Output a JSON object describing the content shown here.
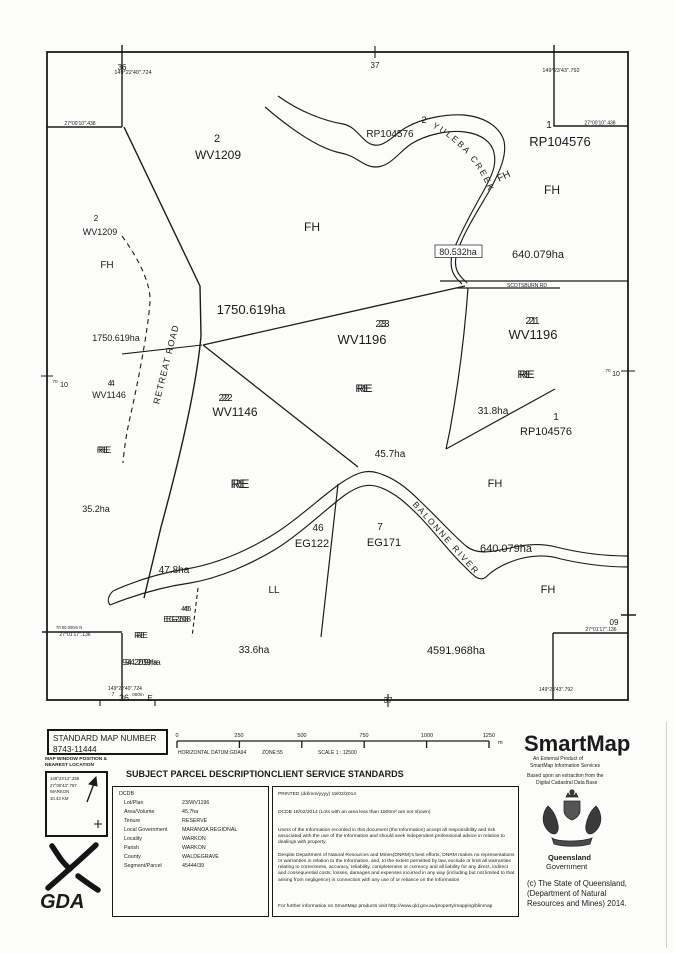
{
  "map": {
    "grid": {
      "top_36": "36",
      "top_37": "37",
      "bottom_37": "37",
      "right_09": "09",
      "left_70": "70",
      "left_10": "10",
      "right_70": "70",
      "right_10": "10",
      "northing_label": "70 00 000m N",
      "easting_prefix": "7",
      "easting_main": "36",
      "easting_suffix": "000m",
      "easting_dir": "E"
    },
    "coords": {
      "top_left_lon": "149°22'40\".724",
      "top_right_lon": "149°23'43\".792",
      "top_left_lat": "27°00'10\".438",
      "top_right_lat": "27°00'10\".438",
      "bottom_left_lat": "27°01'17\".136",
      "bottom_right_lat": "27°01'17\".136",
      "bottom_left_lon": "149°22'40\".724",
      "bottom_right_lon": "149°23'43\".792"
    },
    "roads": {
      "retreat": "RETREAT ROAD",
      "scotsburn": "SCOTSBURN RD"
    },
    "water": {
      "yuleba": "YULEBA CREEK",
      "balonne": "BALONNE RIVER"
    },
    "tenure": {
      "fh": "FH",
      "re": "RE",
      "ll": "LL"
    },
    "parcels": {
      "wv1209_lot": "2",
      "wv1209_plan": "WV1209",
      "rp104576_plan": "RP104576",
      "rp104576_top_lot": "2",
      "rp104576_ne_lot": "1",
      "rp104576_mid_lot": "1",
      "wv1196_plan": "WV1196",
      "wv1196_c_lot": "23",
      "wv1196_e_lot": "21",
      "wv1146_plan": "WV1146",
      "wv1146_w_lot": "4",
      "wv1146_c_lot": "22",
      "eg122_lot": "46",
      "eg122_plan": "EG122",
      "eg171_lot": "7",
      "eg171_plan": "EG171",
      "eg208_lot": "45",
      "eg208_plan": "EG208"
    },
    "areas": {
      "a1750": "1750.619ha",
      "a640": "640.079ha",
      "a80": "80.532ha",
      "a35": "35.2ha",
      "a31": "31.8ha",
      "a45": "45.7ha",
      "a47": "47.8ha",
      "a33": "33.6ha",
      "a4591": "4591.968ha",
      "a94": "94.209ha"
    }
  },
  "footer": {
    "standard_map": {
      "title": "STANDARD MAP NUMBER",
      "number": "8743-11444"
    },
    "scalebar": {
      "ticks": [
        "0",
        "250",
        "500",
        "750",
        "1000",
        "1250"
      ],
      "unit": "m",
      "datum": "HORIZONTAL DATUM:GDA94",
      "zone": "ZONE:55",
      "scale": "SCALE 1 : 12500"
    },
    "map_window": {
      "title_line1": "MAP WINDOW POSITION &",
      "title_line2": "NEAREST LOCATION",
      "lon": "149°23'12\".258",
      "lat": "27°00'43\".787",
      "place": "WARKON",
      "distance": "10.43 KM"
    },
    "gda": "GDA",
    "subject_parcel": {
      "header": "SUBJECT PARCEL DESCRIPTION",
      "source": "DCDB",
      "rows": [
        [
          "Lot/Plan",
          "23/WV1196"
        ],
        [
          "Area/Volume",
          "45.7ha"
        ],
        [
          "Tenure",
          "RESERVE"
        ],
        [
          "Local Government",
          "MARANOA REGIONAL"
        ],
        [
          "Locality",
          "WARKON"
        ],
        [
          "Parish",
          "WARKON"
        ],
        [
          "County",
          "WALDEGRAVE"
        ],
        [
          "Segment/Parcel",
          "45444/39"
        ]
      ]
    },
    "client_service": {
      "header": "CLIENT SERVICE STANDARDS",
      "printed": "PRINTED (dd/mm/yyyy) 19/02/2014",
      "dcdb_line": "DCDB      18/02/2014 (Lots with an area less than 1500m² are not shown)",
      "para1": "Users of the Information recorded in this document (the Information) accept all responsibility and risk associated with the use of the Information and should seek independent professional advice in relation to dealings with property.",
      "para2": "Despite Department of Natural Resources and Mines(DNRM)'s best efforts, DNRM makes no representations or warranties in relation to the Information, and, to the extent permitted by law, exclude or limit all warranties relating to correctness, accuracy, reliability, completeness or currency and all liability for any direct, indirect and consequential costs, losses, damages and expenses incurred in any way (including but not limited to that arising from negligence) in connection with any use of or reliance on the Information",
      "footer_line": "For further information on SmartMap products visit http://www.qld.gov.au/property/mapping/blinmap"
    },
    "branding": {
      "logo": "SmartMap",
      "tagline1": "An External Product of",
      "tagline2": "SmartMap Information Services",
      "extraction1": "Based upon an extraction from the",
      "extraction2": "Digital Cadastral Data Base",
      "gov1": "Queensland",
      "gov2": "Government",
      "copyright1": "(c) The State of Queensland,",
      "copyright2": "(Department of Natural",
      "copyright3": "Resources and Mines) 2014."
    }
  }
}
